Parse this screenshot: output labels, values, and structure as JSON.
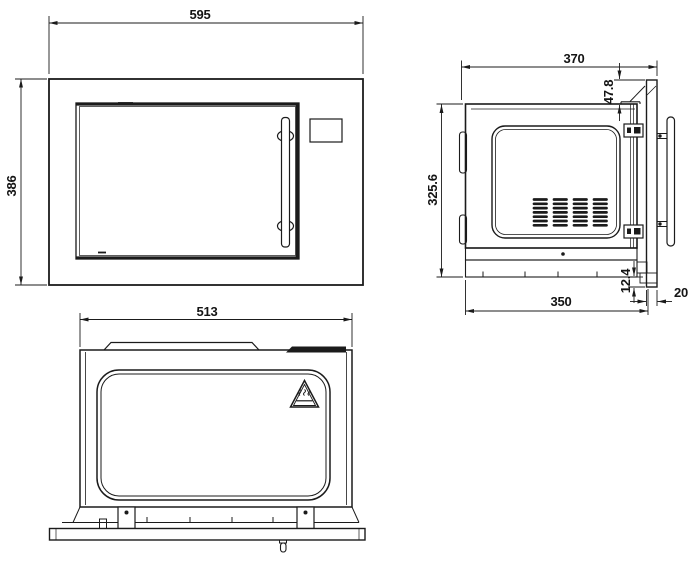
{
  "drawing": {
    "background": "#ffffff",
    "line_color": "#1b1b1b",
    "views": {
      "front": {
        "width": "595",
        "height": "386"
      },
      "side": {
        "overall_depth": "370",
        "case_height": "325.6",
        "trim_top_offset": "47.8",
        "trim_bottom_offset": "12.4",
        "case_depth": "350",
        "trim_thickness": "20"
      },
      "top": {
        "width": "513"
      }
    },
    "icons": {
      "warning_triangle": "hot-surface-warning-icon"
    }
  }
}
